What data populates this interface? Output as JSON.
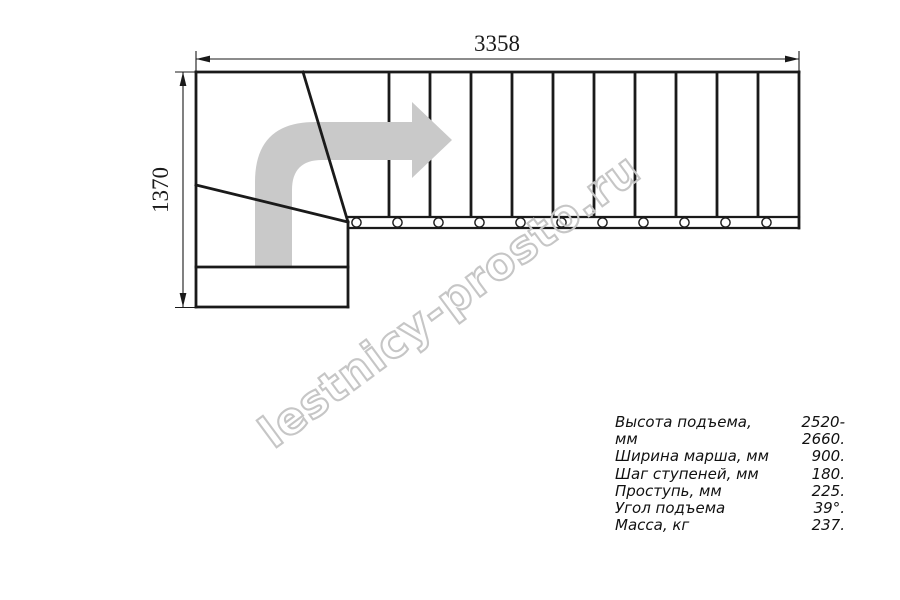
{
  "page": {
    "background": "#ffffff",
    "kind": "staircase-plan-drawing"
  },
  "drawing": {
    "top_dimension_label": "3358",
    "left_dimension_label": "1370",
    "tread_count": 11,
    "watermark_text": "lestnicy-prosto.ru",
    "colors": {
      "line": "#1a1a1a",
      "arrow_fill": "#c9c9c9",
      "watermark_outline": "#c6c6c6"
    }
  },
  "specs": {
    "rows": [
      {
        "label": "Высота подъема, мм",
        "value": "2520-2660."
      },
      {
        "label": "Ширина марша, мм",
        "value": "900."
      },
      {
        "label": "Шаг ступеней, мм",
        "value": "180."
      },
      {
        "label": "Проступь, мм",
        "value": "225."
      },
      {
        "label": "Угол подъема",
        "value": "39°."
      },
      {
        "label": "Масса, кг",
        "value": "237."
      }
    ]
  }
}
